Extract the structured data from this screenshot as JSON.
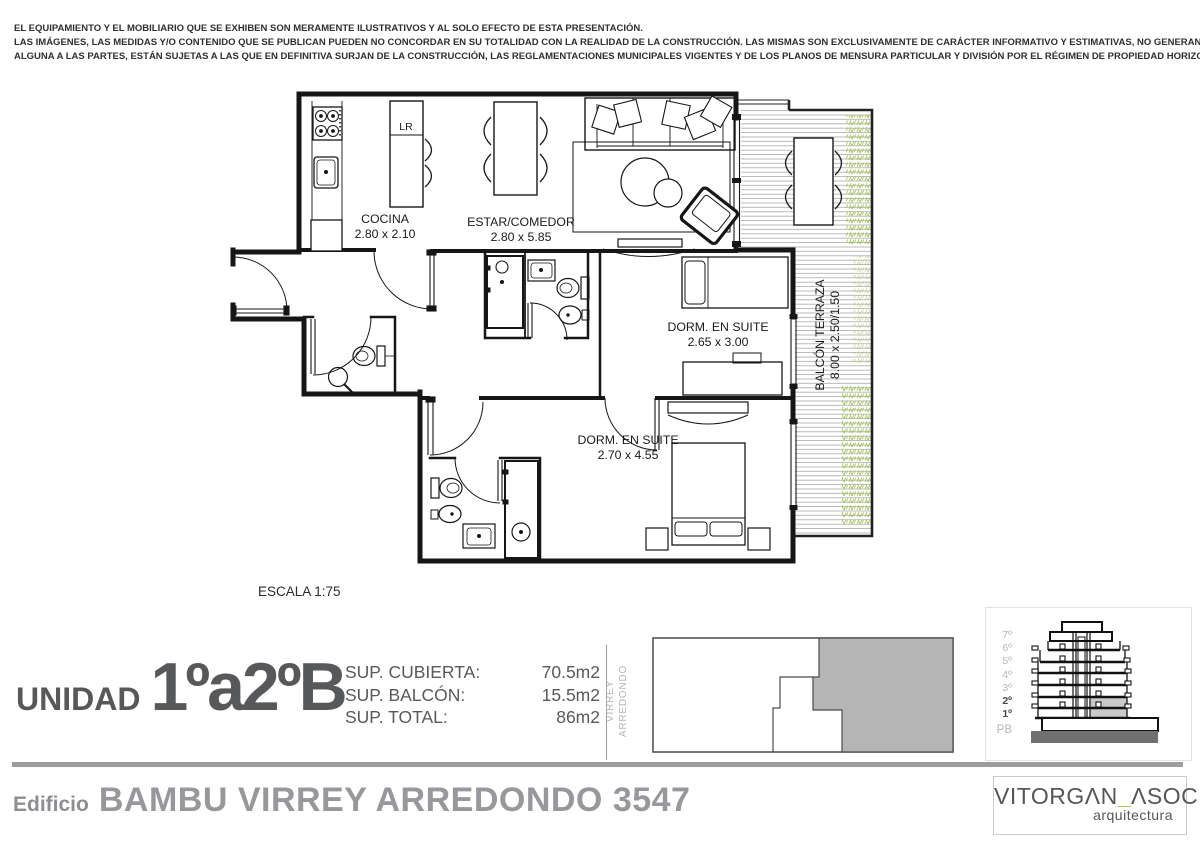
{
  "disclaimer": {
    "line1": "EL EQUIPAMIENTO Y EL MOBILIARIO QUE SE EXHIBEN SON MERAMENTE ILUSTRATIVOS Y AL SOLO EFECTO DE ESTA PRESENTACIÓN.",
    "line2": "LAS IMÁGENES, LAS MEDIDAS Y/O CONTENIDO QUE SE PUBLICAN PUEDEN NO CONCORDAR EN SU TOTALIDAD CON LA REALIDAD DE LA CONSTRUCCIÓN. LAS MISMAS SON EXCLUSIVAMENTE DE CARÁCTER INFORMATIVO Y ESTIMATIVAS, NO GENERANDO OBLIGACIÓN",
    "line3": "ALGUNA A LAS PARTES, ESTÁN SUJETAS A LAS QUE EN DEFINITIVA SURJAN DE LA CONSTRUCCIÓN, LAS REGLAMENTACIONES MUNICIPALES VIGENTES Y DE LOS PLANOS DE MENSURA PARTICULAR Y DIVISIÓN POR EL RÉGIMEN DE PROPIEDAD HORIZONTAL"
  },
  "plan": {
    "scale": "ESCALA 1:75",
    "labels": {
      "lr": "LR"
    },
    "rooms": {
      "cocina": {
        "name": "COCINA",
        "dims": "2.80 x 2.10"
      },
      "estar": {
        "name": "ESTAR/COMEDOR",
        "dims": "2.80 x 5.85"
      },
      "dorm_suite_1": {
        "name": "DORM. EN SUITE",
        "dims": "2.65 x 3.00"
      },
      "dorm_suite_2": {
        "name": "DORM. EN SUITE",
        "dims": "2.70 x 4.55"
      },
      "balcon": {
        "name": "BALCÓN TERRAZA",
        "dims": "8.00 x 2.50/1.50"
      }
    }
  },
  "unit": {
    "prefix": "UNIDAD",
    "number": "1ºa2ºB",
    "surfaces": [
      {
        "label": "SUP. CUBIERTA:",
        "value": "70.5m2"
      },
      {
        "label": "SUP. BALCÓN:",
        "value": "15.5m2"
      },
      {
        "label": "SUP. TOTAL:",
        "value": "86m2"
      }
    ],
    "street_line1": "VIRREY",
    "street_line2": "ARREDONDO"
  },
  "elevation": {
    "floors": [
      "7º",
      "6º",
      "5º",
      "4º",
      "3º",
      "2º",
      "1º",
      "PB"
    ]
  },
  "footer": {
    "prefix": "Edificio",
    "name": "BAMBU VIRREY ARREDONDO 3547"
  },
  "logo": {
    "word1": "VITORGΛN",
    "separator": "_",
    "word2": "ΛSOC",
    "tagline": "arquitectura"
  },
  "colors": {
    "plan_line": "#161616",
    "deck_line": "#a8a8a8",
    "plant_green": "#a3bf55",
    "accent_underscore": "#b2b845",
    "unit_highlight": "#c9c9c9",
    "locator_fill": "#b5b5b5"
  }
}
